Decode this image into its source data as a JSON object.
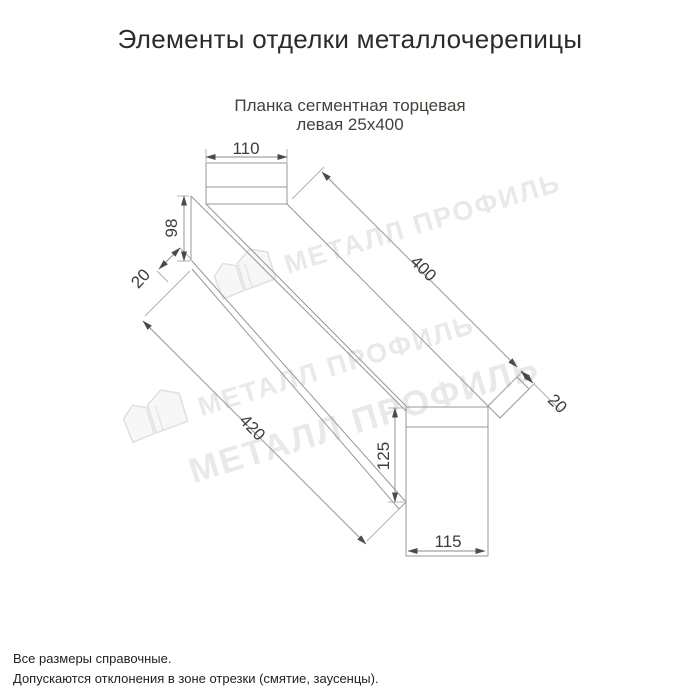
{
  "title": "Элементы отделки металлочерепицы",
  "subtitle": {
    "line1": "Планка сегментная торцевая",
    "line2": "левая 25x400"
  },
  "drawing": {
    "name": "Планка сегментная торцевая левая 25x400",
    "dimensions": {
      "top_tab_width": "110",
      "left_end_height": "98",
      "left_fold": "20",
      "face_length": "400",
      "lower_edge_length": "420",
      "right_fold": "20",
      "bottom_tab_height": "125",
      "bottom_tab_width": "115"
    }
  },
  "watermark": {
    "text": "МЕТАЛЛ ПРОФИЛЬ",
    "color": "#e9e9e9"
  },
  "footer": {
    "line1": "Все размеры справочные.",
    "line2": "Допускаются отклонения в зоне отрезки (смятие, заусенцы)."
  },
  "colors": {
    "title": "#2b2b2b",
    "subtitle": "#45403a",
    "drawing_lines": "#979797",
    "dimension_text": "#3d3d3d",
    "background": "#ffffff"
  }
}
